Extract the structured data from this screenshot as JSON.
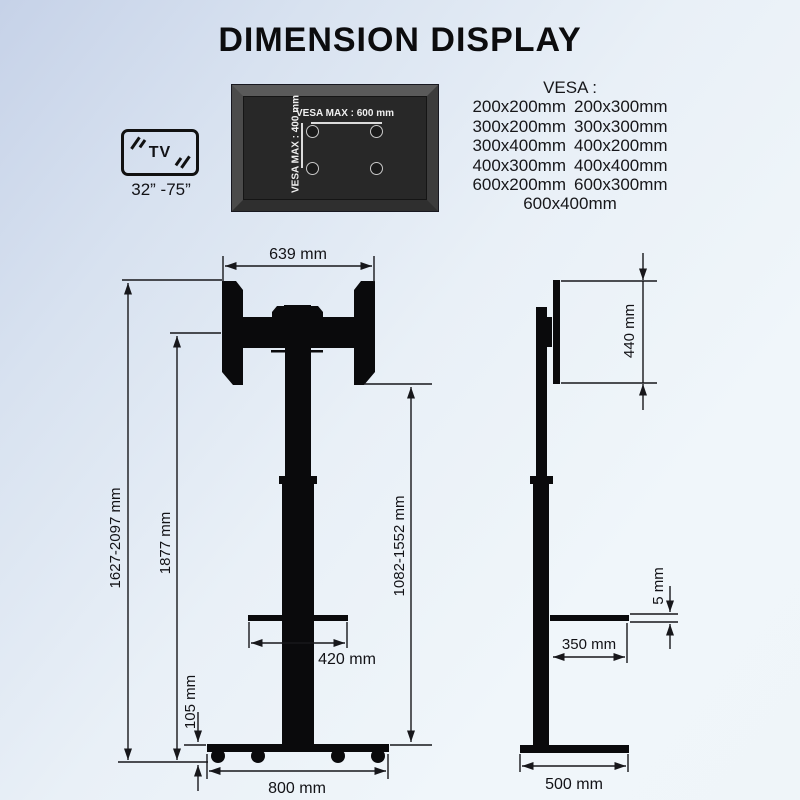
{
  "title": "DIMENSION DISPLAY",
  "tv_badge": {
    "label": "TV",
    "size_range": "32” -75”"
  },
  "vesa_plate": {
    "horizontal_label": "VESA MAX : 600 mm",
    "vertical_label": "VESA MAX : 400 mm"
  },
  "vesa_list": {
    "header": "VESA :",
    "rows": [
      [
        "200x200mm",
        "200x300mm"
      ],
      [
        "300x200mm",
        "300x300mm"
      ],
      [
        "300x400mm",
        "400x200mm"
      ],
      [
        "400x300mm",
        "400x400mm"
      ],
      [
        "600x200mm",
        "600x300mm"
      ]
    ],
    "last_row": "600x400mm"
  },
  "front_view": {
    "top_width": "639 mm",
    "total_height": "1627-2097 mm",
    "column_height": "1877 mm",
    "bracket_height_range": "1082-1552 mm",
    "shelf_width": "420 mm",
    "base_height": "105 mm",
    "base_width": "800 mm"
  },
  "side_view": {
    "panel_height": "440 mm",
    "shelf_thickness": "5 mm",
    "shelf_depth": "350 mm",
    "base_depth": "500 mm"
  },
  "colors": {
    "drawing_ink": "#0a0a0c",
    "dimension_line": "#17171b",
    "plate_frame": "#4b4b4b",
    "plate_panel": "#282828",
    "plate_text": "#efefef",
    "background_top_left": "#c6d2e8",
    "background_bottom_right": "#f0f6fa"
  }
}
